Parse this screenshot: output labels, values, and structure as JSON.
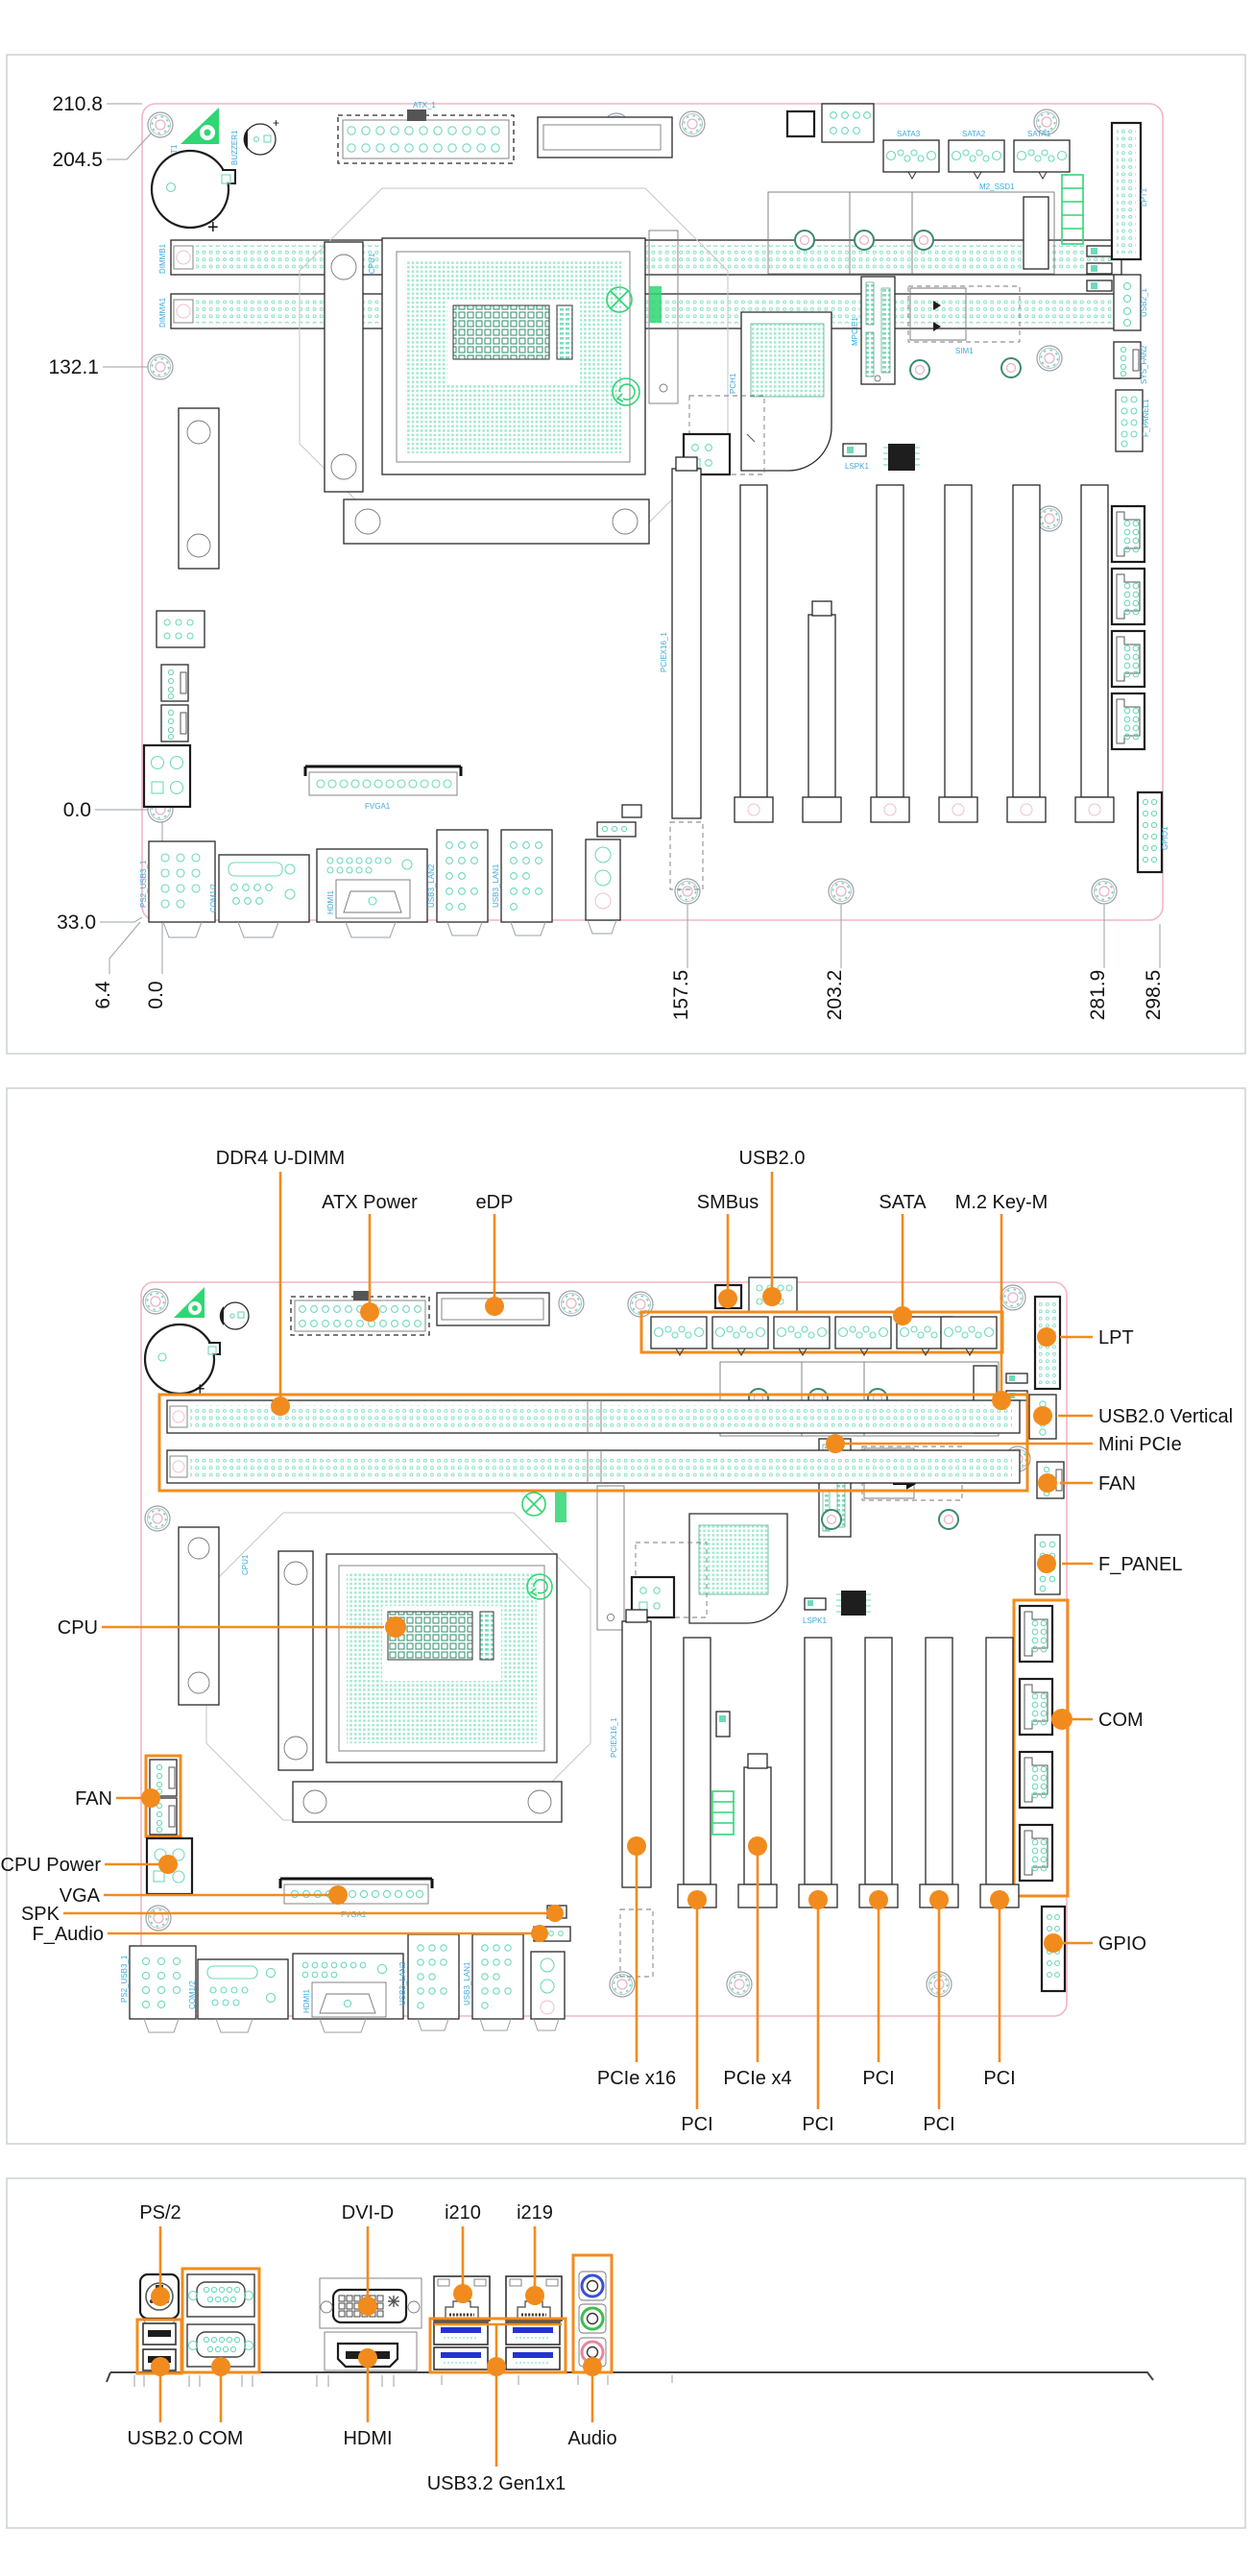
{
  "doc": {
    "kind": "motherboard manual diagrams",
    "background": "#ffffff"
  },
  "colors": {
    "annotation_orange": "#f28b1d",
    "silkscreen_teal": "#6fd9bb",
    "silkscreen_green": "#2fd674",
    "refdes_cyan": "#3fa9dc",
    "board_outline_pink": "#f2b6c4",
    "audio_line_in_blue": "#3a4fd8",
    "audio_line_out_green": "#3bbf4e",
    "audio_mic_pink": "#e8879c",
    "usb3_blue": "#2433cf"
  },
  "fig1": {
    "title": "board dimension drawing",
    "dims": {
      "d210_8": "210.8",
      "d204_5": "204.5",
      "d132_1": "132.1",
      "d0_0_left": "0.0",
      "d33_0": "33.0",
      "d6_4": "6.4",
      "d0_0_bottom": "0.0",
      "d157_5": "157.5",
      "d203_2": "203.2",
      "d281_9": "281.9",
      "d298_5": "298.5"
    }
  },
  "fig2": {
    "title": "connector location drawing",
    "labels": {
      "ddr4": "DDR4 U-DIMM",
      "atx": "ATX Power",
      "edp": "eDP",
      "smbus": "SMBus",
      "usb20_top": "USB2.0",
      "sata": "SATA",
      "m2": "M.2 Key-M",
      "lpt": "LPT",
      "usb20v": "USB2.0 Vertical",
      "minipcie": "Mini PCIe",
      "fan_right": "FAN",
      "fpanel": "F_PANEL",
      "com": "COM",
      "gpio": "GPIO",
      "cpu": "CPU",
      "fan_left": "FAN",
      "cpupower": "CPU Power",
      "vga": "VGA",
      "spk": "SPK",
      "faudio": "F_Audio",
      "pciex16": "PCIe x16",
      "pciex4": "PCIe x4",
      "pci": "PCI"
    }
  },
  "fig3": {
    "title": "rear I/O drawing",
    "labels": {
      "ps2": "PS/2",
      "dvid": "DVI-D",
      "i210": "i210",
      "i219": "i219",
      "usb20": "USB2.0",
      "com": "COM",
      "hdmi": "HDMI",
      "audio": "Audio",
      "usb32": "USB3.2 Gen1x1"
    }
  },
  "silkscreen": {
    "dimmb1": "DIMMB1",
    "dimma1": "DIMMA1",
    "bat1": "BAT1",
    "buzzer1": "BUZZER1",
    "atx_1": "ATX_1",
    "pch1": "PCH1",
    "m2_ssd1": "M2_SSD1",
    "sim1": "SIM1",
    "mpcie1": "MPCIE1",
    "sys_fan2": "SYS_FAN2",
    "f_panel1": "F_PANEL1",
    "lpt1": "LPT1",
    "usb2_1": "USB2_1",
    "gpio1": "GPIO1",
    "cpu1": "CPU1",
    "ps2_usb3_1": "PS2_USB3_1",
    "com12": "COM1/2",
    "hdmi1": "HDMI1",
    "usb3_lan1": "USB3_LAN1",
    "usb3_lan2": "USB3_LAN2",
    "fvga1": "FVGA1",
    "sata1": "SATA1",
    "sata2": "SATA2",
    "sata3": "SATA3",
    "pciex16_1": "PCIEX16_1",
    "lspk1": "LSPK1"
  }
}
